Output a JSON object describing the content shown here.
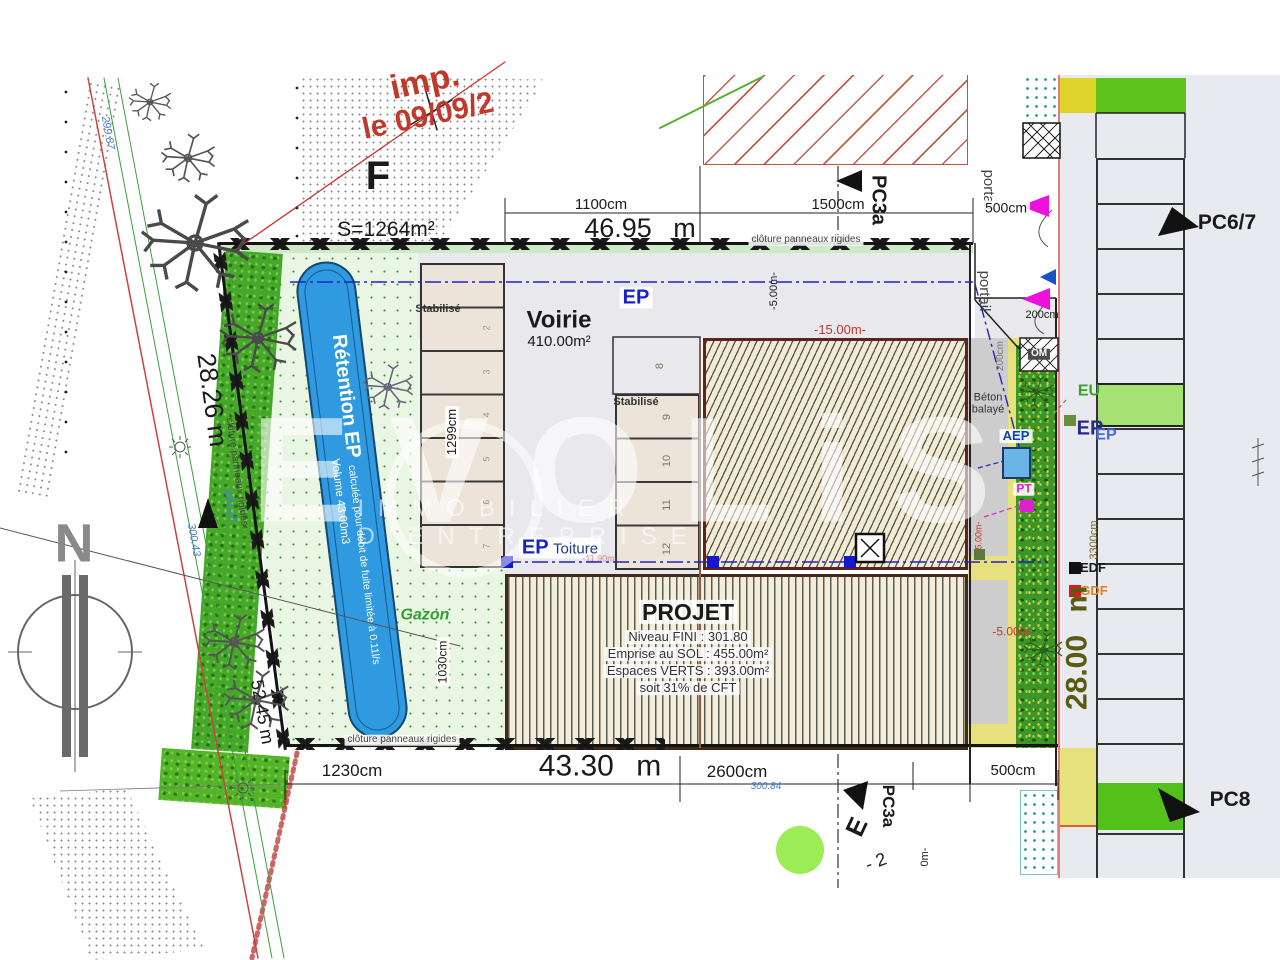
{
  "meta": {
    "stamp_line1": "imp.",
    "stamp_line2": "le 09/09/2",
    "plan_letter": "F",
    "surface_label": "S=1264m²"
  },
  "watermark": {
    "brand": "EVOLiS",
    "subtitle": "IMMOBILIER D'ENTREPRISE"
  },
  "compass": {
    "north": "N"
  },
  "dims": {
    "top_total": "46.95 m",
    "top_seg1": "1100cm",
    "top_seg2": "1500cm",
    "bottom_seg1": "1230cm",
    "bottom_total": "43.30 m",
    "bottom_seg2": "2600cm",
    "bottom_seg3": "500cm",
    "left_side": "28.26 m",
    "left_side2": "52.45 m",
    "right_side": "28.00 m",
    "right_len": "3300cm",
    "stall_depth": "1299cm",
    "green_width": "1030cm",
    "gate_width": "500cm",
    "gate2_width": "200cm",
    "strip_width": "200cm",
    "off_15": "-15.00m-",
    "off_5_top": "-5.00m-",
    "off_5_right": "-5.00m-",
    "off_5_gate": "-5.00m-",
    "off_1190": "-11.90m-",
    "off_bottom": "0m-",
    "minus2": "- 2"
  },
  "levels": {
    "l1": "299.87",
    "l2": "300.20",
    "l3": "300.43",
    "l4": "300.84"
  },
  "zones": {
    "voirie": "Voirie",
    "voirie_area": "410.00m²",
    "gazon": "Gazon",
    "stabilise1": "Stabilisé",
    "stabilise2": "Stabilisé",
    "beton": "Béton balayé"
  },
  "basin": {
    "title": "Rétention EP",
    "note": "calculée pour débit de fuite limitée à 0.11l/s",
    "volume": "Volume 43.00m3"
  },
  "projet": {
    "title": "PROJET",
    "line1": "Niveau FINI : 301.80",
    "line2": "Emprise au SOL : 455.00m²",
    "line3": "Espaces VERTS : 393.00m²",
    "line4": "soit 31% de CFT"
  },
  "fence": {
    "label_top": "clôture panneaux rigides",
    "label_left": "clôture panneaux rigides",
    "label_bottom": "clôture panneaux rigides"
  },
  "networks": {
    "ep_main": "EP",
    "ep_toiture": "EP",
    "toiture": "Toiture",
    "aep": "AEP",
    "pt": "PT",
    "eu": "EU",
    "ep_r1": "EP",
    "ep_r2": "EP",
    "edf": "EDF",
    "gdf": "GDF",
    "om": "OM"
  },
  "markers": {
    "pc3a_top": "PC3a",
    "pc3a_bottom": "PC3a",
    "pc67": "PC6/7",
    "pc8": "PC8",
    "portail1": "portail",
    "portail2": "portail",
    "e_letter": "E"
  },
  "stalls": {
    "mid": [
      "8",
      "9",
      "10",
      "11",
      "12"
    ],
    "left": [
      "2",
      "3",
      "4",
      "5",
      "6",
      "7"
    ]
  }
}
